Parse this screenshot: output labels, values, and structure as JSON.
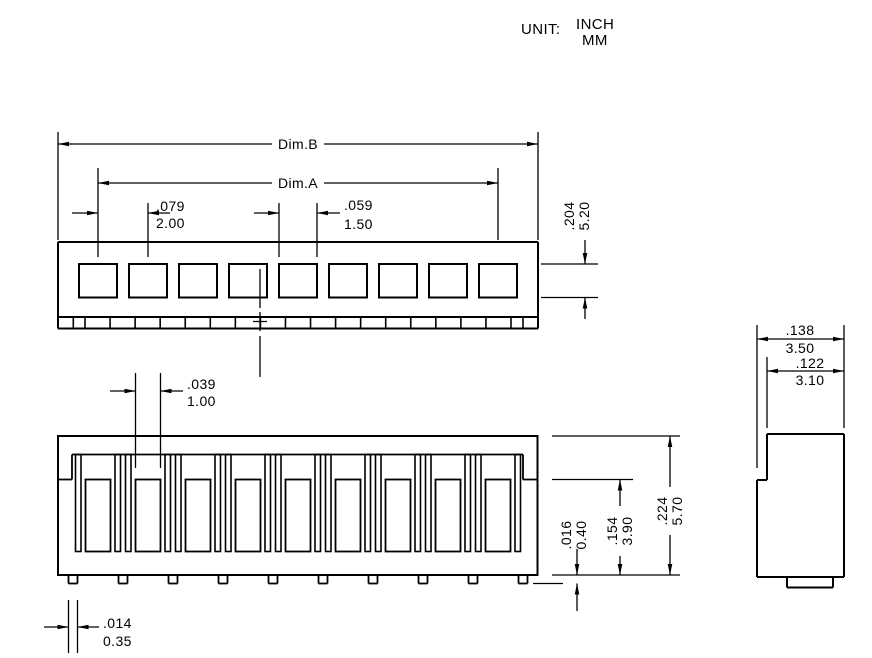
{
  "title": {
    "unit_label": "UNIT:",
    "unit_inch": "INCH",
    "unit_mm": "MM"
  },
  "structure": {
    "positions": 9,
    "top_holes": 9,
    "bottom_tabs": 10,
    "line_color": "#000000",
    "background_color": "#ffffff"
  },
  "dims": {
    "dim_b": {
      "label": "Dim.B"
    },
    "dim_a": {
      "label": "Dim.A"
    },
    "pitch": {
      "inch": ".079",
      "mm": "2.00"
    },
    "hole_width": {
      "inch": ".059",
      "mm": "1.50"
    },
    "housing_depth": {
      "inch": ".204",
      "mm": "5.20"
    },
    "slot_width": {
      "inch": ".039",
      "mm": "1.00"
    },
    "pin_protrusion": {
      "inch": ".016",
      "mm": "0.40"
    },
    "cavity_height": {
      "inch": ".154",
      "mm": "3.90"
    },
    "housing_height": {
      "inch": ".224",
      "mm": "5.70"
    },
    "pin_width": {
      "inch": ".014",
      "mm": "0.35"
    },
    "side_depth": {
      "inch": ".138",
      "mm": "3.50"
    },
    "side_inner_depth": {
      "inch": ".122",
      "mm": "3.10"
    }
  }
}
